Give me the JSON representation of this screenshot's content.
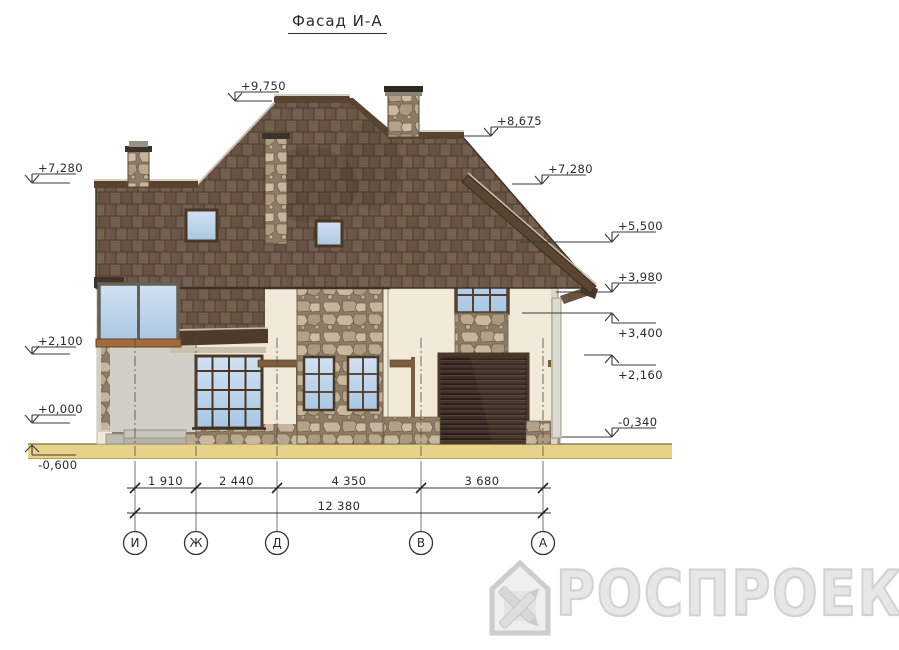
{
  "title": "Фасад И-А",
  "drawing": {
    "elevation_marks_left": [
      {
        "value": "+9,750"
      },
      {
        "value": "+7,280"
      },
      {
        "value": "+2,100"
      },
      {
        "value": "+0,000"
      },
      {
        "value": "-0,600"
      }
    ],
    "elevation_marks_right": [
      {
        "value": "+8,675"
      },
      {
        "value": "+7,280"
      },
      {
        "value": "+5,500"
      },
      {
        "value": "+3,980"
      },
      {
        "value": "+3,400"
      },
      {
        "value": "+2,160"
      },
      {
        "value": "-0,340"
      }
    ],
    "dimensions": {
      "segments": [
        "1 910",
        "2 440",
        "4 350",
        "3 680"
      ],
      "total": "12 380"
    },
    "axes": [
      "И",
      "Ж",
      "Д",
      "В",
      "А"
    ]
  },
  "watermark": {
    "logo_text": "РОСПРОЕКТ"
  },
  "colors": {
    "roof_brown": "#6d5847",
    "roof_trim": "#4e3b29",
    "wall_cream": "#f0e9d7",
    "porch_gray": "#d2cfc6",
    "stone_tan": "#b3a288",
    "glass_blue": "#aecbe6",
    "garage_dark": "#3a2d22",
    "ground_tan": "#e7d28a",
    "line_ink": "#3a3a3a",
    "watermark_gray": "#d2d2d2"
  }
}
